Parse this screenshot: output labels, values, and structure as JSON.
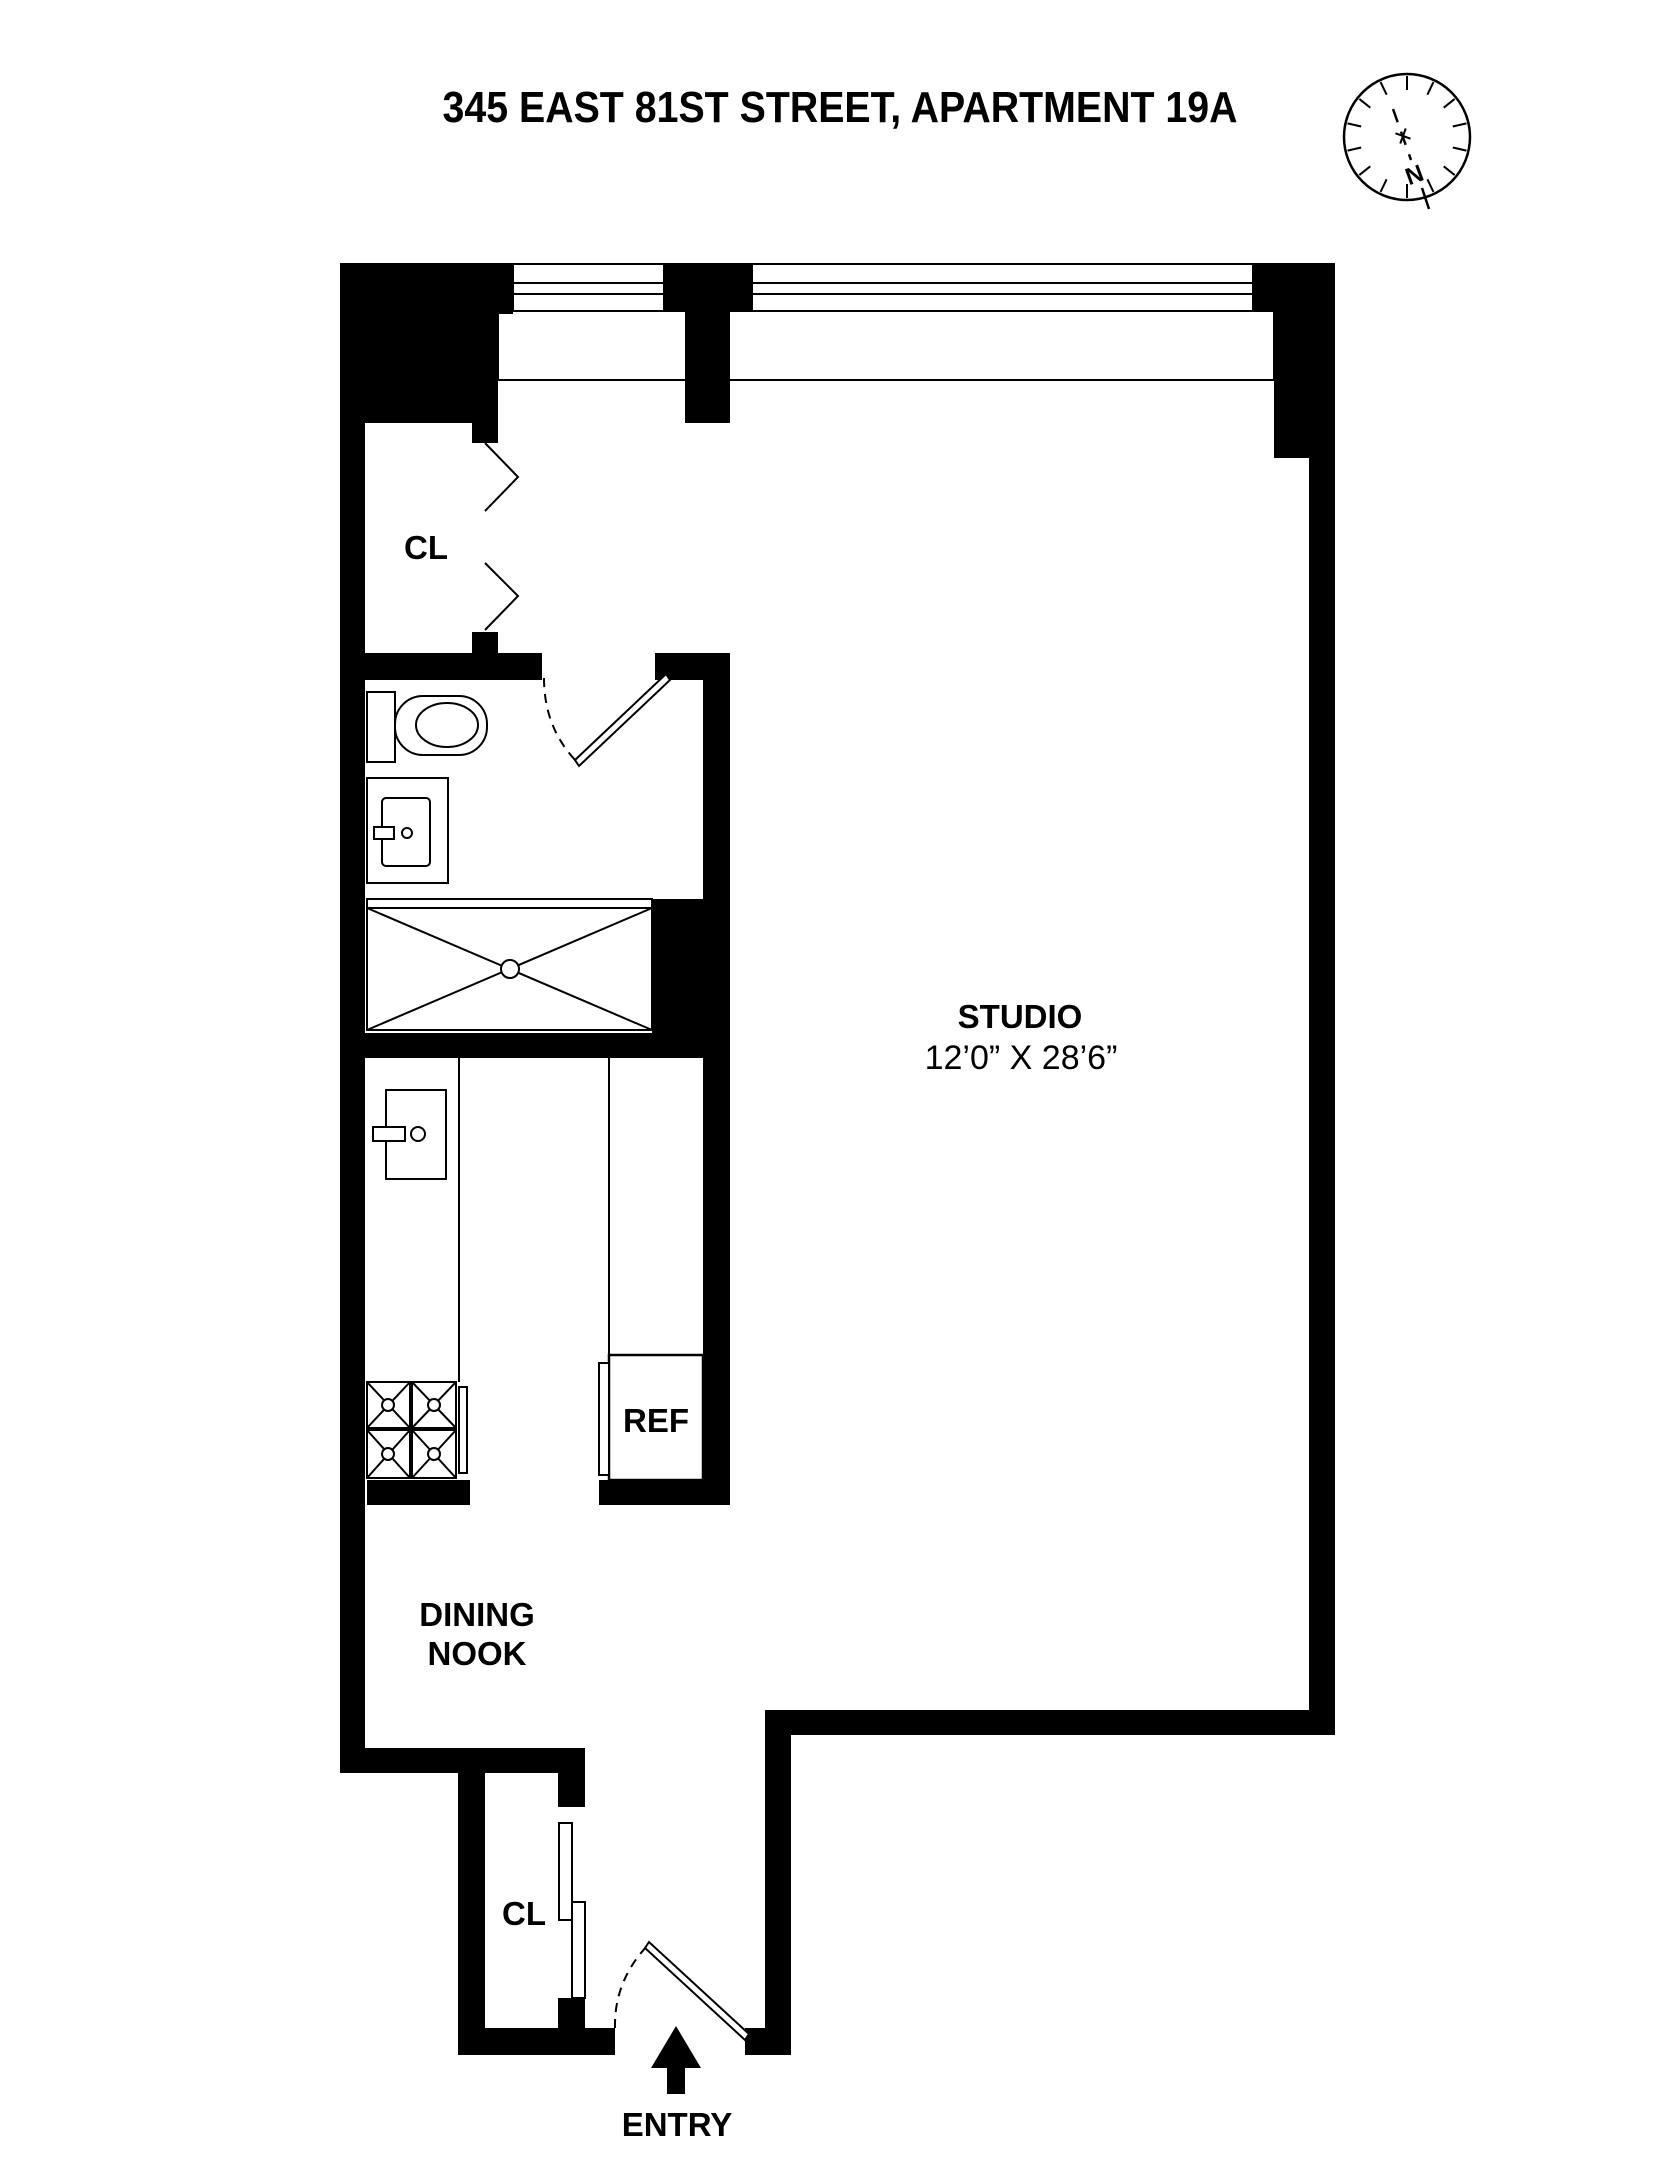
{
  "page": {
    "background": "#ffffff",
    "line_color": "#000000"
  },
  "header": {
    "title": "345 EAST 81ST STREET, APARTMENT 19A"
  },
  "compass": {
    "north_label": "N"
  },
  "labels": {
    "closet_upper": "CL",
    "studio_name": "STUDIO",
    "studio_dimensions": "12’0” X 28’6”",
    "refrigerator": "REF",
    "dining_line1": "DINING",
    "dining_line2": "NOOK",
    "closet_entry": "CL",
    "entry": "ENTRY"
  }
}
